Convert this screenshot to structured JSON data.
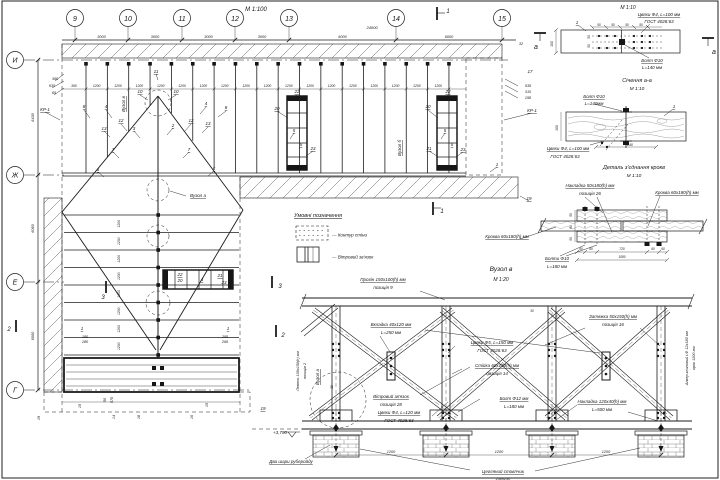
{
  "plan": {
    "scale": "М 1:100",
    "grid": {
      "cols": [
        "9",
        "10",
        "11",
        "12",
        "13",
        "14",
        "15"
      ],
      "col_dims": [
        "3000",
        "3000",
        "3000",
        "3000",
        "6000",
        "6000"
      ],
      "total": "24000",
      "rows": [
        "И",
        "Ж",
        "Е",
        "Г"
      ],
      "row_dims": [
        "6430",
        "6060",
        "6000"
      ]
    },
    "top_row": [
      "360",
      "1200",
      "1200",
      "1200",
      "1200",
      "1200",
      "1200",
      "1200",
      "1200",
      "1200",
      "1200",
      "1200",
      "1200",
      "1200",
      "1200",
      "1200",
      "1200",
      "1200"
    ],
    "left_col": [
      "1200",
      "1200",
      "1200",
      "1200",
      "1200",
      "1200",
      "1200",
      "1200"
    ],
    "callouts": [
      {
        "t": "24000",
        "x": 372,
        "y": 29,
        "s": 4
      },
      {
        "t": "11",
        "x": 156,
        "y": 73,
        "u": 1
      },
      {
        "t": "10",
        "x": 140,
        "y": 93,
        "u": 1
      },
      {
        "t": "10",
        "x": 176,
        "y": 93,
        "u": 1
      },
      {
        "t": "12",
        "x": 121,
        "y": 122,
        "u": 1
      },
      {
        "t": "12",
        "x": 191,
        "y": 122,
        "u": 1
      },
      {
        "t": "13",
        "x": 104,
        "y": 130,
        "u": 1
      },
      {
        "t": "13",
        "x": 208,
        "y": 125,
        "u": 1
      },
      {
        "t": "3",
        "x": 134,
        "y": 130,
        "u": 1
      },
      {
        "t": "2",
        "x": 173,
        "y": 127,
        "u": 1
      },
      {
        "t": "8",
        "x": 84,
        "y": 108,
        "u": 1
      },
      {
        "t": "4",
        "x": 106,
        "y": 108,
        "u": 1
      },
      {
        "t": "4",
        "x": 206,
        "y": 105,
        "u": 1
      },
      {
        "t": "8",
        "x": 226,
        "y": 109,
        "u": 1
      },
      {
        "t": "7",
        "x": 113,
        "y": 151,
        "u": 1
      },
      {
        "t": "7",
        "x": 189,
        "y": 151,
        "u": 1
      },
      {
        "t": "6",
        "x": 98,
        "y": 171,
        "u": 1
      },
      {
        "t": "6",
        "x": 214,
        "y": 170,
        "u": 1
      },
      {
        "t": "20",
        "x": 277,
        "y": 110,
        "u": 1
      },
      {
        "t": "22",
        "x": 297,
        "y": 93,
        "u": 1
      },
      {
        "t": "5",
        "x": 294,
        "y": 132,
        "u": 1
      },
      {
        "t": "5",
        "x": 301,
        "y": 146,
        "u": 1
      },
      {
        "t": "23",
        "x": 313,
        "y": 150,
        "u": 1
      },
      {
        "t": "20",
        "x": 428,
        "y": 108,
        "u": 1
      },
      {
        "t": "22",
        "x": 448,
        "y": 93,
        "u": 1
      },
      {
        "t": "5",
        "x": 445,
        "y": 132,
        "u": 1
      },
      {
        "t": "21",
        "x": 429,
        "y": 150,
        "u": 1
      },
      {
        "t": "5",
        "x": 452,
        "y": 146,
        "u": 1
      },
      {
        "t": "23",
        "x": 463,
        "y": 151,
        "u": 1
      },
      {
        "t": "1",
        "x": 497,
        "y": 166,
        "u": 1
      },
      {
        "t": "19",
        "x": 529,
        "y": 200,
        "u": 1
      },
      {
        "t": "17",
        "x": 530,
        "y": 73
      },
      {
        "t": "535",
        "x": 528,
        "y": 87,
        "s": 3.8
      },
      {
        "t": "310",
        "x": 528,
        "y": 93,
        "s": 3.8
      },
      {
        "t": "158",
        "x": 528,
        "y": 99,
        "s": 3.8
      },
      {
        "t": "КР-1",
        "x": 532,
        "y": 112,
        "u": 1
      },
      {
        "t": "32",
        "x": 521,
        "y": 45,
        "s": 3.8
      },
      {
        "t": "360",
        "x": 55,
        "y": 80,
        "s": 3.8
      },
      {
        "t": "535",
        "x": 52,
        "y": 87,
        "s": 3.8
      },
      {
        "t": "65",
        "x": 54,
        "y": 94,
        "s": 3.8
      },
      {
        "t": "КР-1",
        "x": 45,
        "y": 111,
        "u": 1
      },
      {
        "t": "Вузол в",
        "x": 125,
        "y": 104,
        "r": -90,
        "u": 1
      },
      {
        "t": "Вузол а",
        "x": 198,
        "y": 197,
        "u": 1
      },
      {
        "t": "Вузол б",
        "x": 401,
        "y": 148,
        "r": -90,
        "u": 1
      },
      {
        "t": "22",
        "x": 180,
        "y": 276,
        "u": 1
      },
      {
        "t": "20",
        "x": 180,
        "y": 282
      },
      {
        "t": "4",
        "x": 202,
        "y": 281,
        "u": 1
      },
      {
        "t": "21",
        "x": 220,
        "y": 277,
        "u": 1
      },
      {
        "t": "23",
        "x": 224,
        "y": 284
      },
      {
        "t": "1",
        "x": 82,
        "y": 330,
        "u": 1
      },
      {
        "t": "1",
        "x": 228,
        "y": 330,
        "u": 1
      },
      {
        "t": "180",
        "x": 85,
        "y": 338,
        "s": 3.8
      },
      {
        "t": "180",
        "x": 85,
        "y": 343,
        "s": 3.8
      },
      {
        "t": "255",
        "x": 225,
        "y": 338,
        "s": 3.8
      },
      {
        "t": "265",
        "x": 225,
        "y": 343,
        "s": 3.8
      },
      {
        "t": "570",
        "x": 113,
        "y": 400,
        "r": -90,
        "s": 3.8
      },
      {
        "t": "50",
        "x": 106,
        "y": 400,
        "r": -90,
        "s": 3.8
      },
      {
        "t": "15",
        "x": 81,
        "y": 406,
        "r": -90,
        "s": 3.8
      },
      {
        "t": "15",
        "x": 208,
        "y": 405,
        "r": -90,
        "s": 3.8
      },
      {
        "t": "14",
        "x": 115,
        "y": 417,
        "r": -90,
        "s": 3.8
      },
      {
        "t": "18",
        "x": 140,
        "y": 417,
        "r": -90,
        "s": 3.8
      },
      {
        "t": "16",
        "x": 193,
        "y": 417,
        "r": -90,
        "s": 3.8
      },
      {
        "t": "19",
        "x": 40,
        "y": 418,
        "r": -90,
        "s": 3.8
      },
      {
        "t": "19",
        "x": 263,
        "y": 410,
        "u": 1
      },
      {
        "t": "3",
        "x": 103,
        "y": 299,
        "s": 6
      },
      {
        "t": "3",
        "x": 280,
        "y": 288,
        "s": 6
      },
      {
        "t": "2",
        "x": 9,
        "y": 331,
        "s": 6
      },
      {
        "t": "2",
        "x": 283,
        "y": 337,
        "s": 6
      },
      {
        "t": "1",
        "x": 448,
        "y": 13,
        "s": 6
      },
      {
        "t": "1",
        "x": 442,
        "y": 213,
        "s": 6
      }
    ]
  },
  "legend": {
    "title": "Умовні позначення",
    "items": [
      "—  Контур стіни",
      "—  Вітровий зв'язок"
    ]
  },
  "details": {
    "d1": {
      "scale": "М 1:10",
      "texts": [
        {
          "t": "Цвяхи Ф4, L=100 мм",
          "x": 659,
          "y": 16,
          "u": 1
        },
        {
          "t": "ГОСТ 4028:63",
          "x": 659,
          "y": 23
        },
        {
          "t": "1",
          "x": 577,
          "y": 24,
          "u": 1
        },
        {
          "t": "Болт Ф10",
          "x": 652,
          "y": 62,
          "u": 1
        },
        {
          "t": "L=140 мм",
          "x": 652,
          "y": 69
        },
        {
          "t": "а",
          "x": 536,
          "y": 49,
          "s": 7
        },
        {
          "t": "а",
          "x": 714,
          "y": 54,
          "s": 7
        },
        {
          "t": "100",
          "x": 553,
          "y": 44,
          "r": -90,
          "s": 3.5
        },
        {
          "t": "50",
          "x": 599,
          "y": 26,
          "s": 3.2
        },
        {
          "t": "50",
          "x": 613,
          "y": 26,
          "s": 3.2
        },
        {
          "t": "50",
          "x": 627,
          "y": 26,
          "s": 3.2
        },
        {
          "t": "50",
          "x": 641,
          "y": 26,
          "s": 3.2
        },
        {
          "t": "50",
          "x": 590,
          "y": 37,
          "r": -90,
          "s": 3.2
        },
        {
          "t": "50",
          "x": 590,
          "y": 46,
          "r": -90,
          "s": 3.2
        }
      ]
    },
    "section_aa": {
      "title": "Січення а-а",
      "scale": "М 1:10",
      "texts": [
        {
          "t": "Болт Ф10",
          "x": 594,
          "y": 98,
          "u": 1
        },
        {
          "t": "L=140мм",
          "x": 594,
          "y": 105
        },
        {
          "t": "1",
          "x": 674,
          "y": 108,
          "u": 1
        },
        {
          "t": "Цвяхи Ф4, L=100 мм",
          "x": 568,
          "y": 150,
          "u": 1
        },
        {
          "t": "ГОСТ 4028:63",
          "x": 565,
          "y": 158
        },
        {
          "t": "240",
          "x": 630,
          "y": 146,
          "s": 3.5
        },
        {
          "t": "100",
          "x": 558,
          "y": 128,
          "r": -90,
          "s": 3.5
        }
      ]
    },
    "rafter": {
      "title": "Деталь з'єднання крокв",
      "scale": "М 1:10",
      "texts": [
        {
          "t": "Накладка 50х180(h) мм",
          "x": 590,
          "y": 187,
          "u": 1
        },
        {
          "t": "позиція 26",
          "x": 590,
          "y": 195
        },
        {
          "t": "Кроква 60х180(h) мм",
          "x": 677,
          "y": 194,
          "u": 1
        },
        {
          "t": "Кроква 60х180(h) мм",
          "x": 507,
          "y": 238,
          "u": 1
        },
        {
          "t": "Болти Ф10",
          "x": 557,
          "y": 260,
          "u": 1
        },
        {
          "t": "L=180 мм",
          "x": 557,
          "y": 268
        },
        {
          "t": "60",
          "x": 581,
          "y": 250,
          "s": 3.2
        },
        {
          "t": "60",
          "x": 591,
          "y": 250,
          "s": 3.2
        },
        {
          "t": "720",
          "x": 622,
          "y": 250,
          "s": 3.2
        },
        {
          "t": "60",
          "x": 653,
          "y": 250,
          "s": 3.2
        },
        {
          "t": "60",
          "x": 663,
          "y": 250,
          "s": 3.2
        },
        {
          "t": "1080",
          "x": 622,
          "y": 258,
          "s": 3.2
        },
        {
          "t": "50",
          "x": 572,
          "y": 215,
          "r": -90,
          "s": 3.2
        },
        {
          "t": "60",
          "x": 572,
          "y": 227,
          "r": -90,
          "s": 3.2
        },
        {
          "t": "50",
          "x": 572,
          "y": 239,
          "r": -90,
          "s": 3.2
        }
      ]
    },
    "node_v": {
      "title": "Вузол в",
      "scale": "М 1:20",
      "texts": [
        {
          "t": "Прогін 150х100(h) мм",
          "x": 383,
          "y": 281,
          "u": 1
        },
        {
          "t": "позиція 9",
          "x": 383,
          "y": 289
        },
        {
          "t": "Вкладка 40х120 мм",
          "x": 391,
          "y": 326,
          "u": 1
        },
        {
          "t": "L=250 мм",
          "x": 391,
          "y": 334
        },
        {
          "t": "Затяжка 50х150(h) мм",
          "x": 613,
          "y": 318,
          "u": 1
        },
        {
          "t": "позиція 16",
          "x": 613,
          "y": 326
        },
        {
          "t": "Цвяхи Ф5, L=150 мм",
          "x": 492,
          "y": 344,
          "u": 1
        },
        {
          "t": "ГОСТ 4028:63",
          "x": 492,
          "y": 352
        },
        {
          "t": "Стійка 60х150(h) мм",
          "x": 497,
          "y": 367,
          "u": 1
        },
        {
          "t": "позиція 14",
          "x": 497,
          "y": 375
        },
        {
          "t": "Вітровий зв'язок",
          "x": 391,
          "y": 398,
          "u": 1
        },
        {
          "t": "позиція 28",
          "x": 391,
          "y": 406
        },
        {
          "t": "Цвяхи Ф4, L=120 мм",
          "x": 399,
          "y": 414,
          "u": 1
        },
        {
          "t": "ГОСТ 4028:63",
          "x": 399,
          "y": 422
        },
        {
          "t": "Болт Ф12 мм",
          "x": 514,
          "y": 400,
          "u": 1
        },
        {
          "t": "L=180 мм",
          "x": 514,
          "y": 408
        },
        {
          "t": "Накладка 120х40(h) мм",
          "x": 602,
          "y": 403,
          "u": 1
        },
        {
          "t": "L=500 мм",
          "x": 602,
          "y": 411
        },
        {
          "t": "Лежень 100х150(h) мм",
          "x": 299,
          "y": 371,
          "r": -90,
          "s": 3.8
        },
        {
          "t": "позиція 2",
          "x": 306,
          "y": 371,
          "r": -90,
          "s": 3.8
        },
        {
          "t": "Вузол а",
          "x": 319,
          "y": 377,
          "r": -90,
          "u": 1
        },
        {
          "t": "Анкер клиновий LФ 12х180 мм",
          "x": 688,
          "y": 358,
          "r": -90,
          "s": 3.8
        },
        {
          "t": "крок 1200 мм",
          "x": 695,
          "y": 358,
          "r": -90,
          "s": 3.8
        },
        {
          "t": "+3,790",
          "x": 280,
          "y": 434,
          "s": 4.5
        },
        {
          "t": "Два шари руберойду",
          "x": 291,
          "y": 463,
          "u": 1
        },
        {
          "t": "Цегляний стовпчик",
          "x": 503,
          "y": 473,
          "u": 1
        },
        {
          "t": "250х250",
          "x": 503,
          "y": 480,
          "s": 3.8
        },
        {
          "t": "1200",
          "x": 391,
          "y": 453,
          "s": 3.8
        },
        {
          "t": "1200",
          "x": 499,
          "y": 453,
          "s": 3.8
        },
        {
          "t": "1200",
          "x": 606,
          "y": 453,
          "s": 3.8
        },
        {
          "t": "30",
          "x": 532,
          "y": 312,
          "s": 3.2
        },
        {
          "t": "30",
          "x": 333,
          "y": 387,
          "r": -90,
          "s": 3.2
        }
      ]
    }
  }
}
